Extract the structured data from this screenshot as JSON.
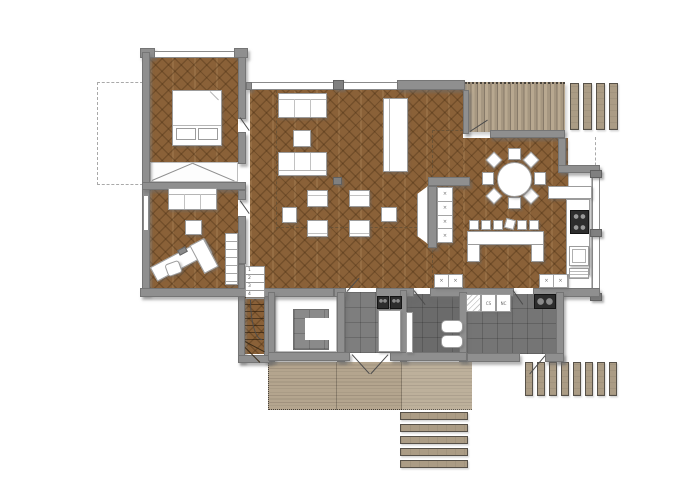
{
  "title": "house-first-floor-plan",
  "palette": {
    "background": "#ffffff",
    "wall": "#8f8f8f",
    "wall_edge": "#757575",
    "parquet_base": "#8a6138",
    "parquet_joint": "#6f4c29",
    "deck_base": "#ab9c85",
    "deck_gap": "#877a69",
    "tile_entry": "#7e7e7e",
    "tile_bath": "#6b6b6b",
    "tile_utility": "#757575",
    "furniture_fill": "#ffffff",
    "furniture_line": "#9c9c9c",
    "shadow": "rgba(110,110,110,0.5)"
  },
  "marks": {
    "cabinet_x": "×"
  },
  "stairs": {
    "steps": [
      "1",
      "2",
      "3",
      "4"
    ]
  },
  "utility_cabinet_labels": {
    "left": "CS",
    "right": "NC"
  }
}
